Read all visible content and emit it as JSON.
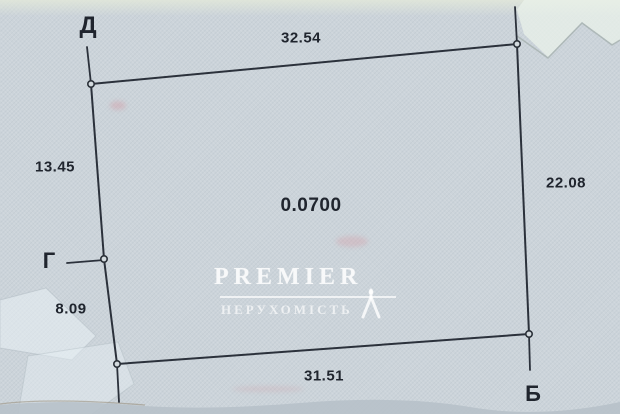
{
  "plan": {
    "type": "land-parcel-boundary-plan",
    "area_ha": "0.0700",
    "vertex_labels": {
      "d": "Д",
      "g": "Г",
      "b": "Б"
    },
    "side_lengths": {
      "top": "32.54",
      "right": "22.08",
      "bottom": "31.51",
      "left_upper": "13.45",
      "left_lower": "8.09"
    },
    "sides": [
      {
        "from": "Д",
        "to": "(top-right)",
        "length": 32.54
      },
      {
        "from": "(top-right)",
        "to": "Б",
        "length": 22.08
      },
      {
        "from": "Б",
        "to": "(bottom-left)",
        "length": 31.51
      },
      {
        "from": "(bottom-left)",
        "to": "Г",
        "length": 8.09
      },
      {
        "from": "Г",
        "to": "Д",
        "length": 13.45
      }
    ]
  },
  "watermark": {
    "brand": "Premier",
    "subtitle": "НЕРУХОМІСТЬ"
  },
  "colors": {
    "paper": "#ccd4da",
    "boundary_line": "#2b313b",
    "label_text": "#20252e",
    "watermark": "#ffffff"
  }
}
